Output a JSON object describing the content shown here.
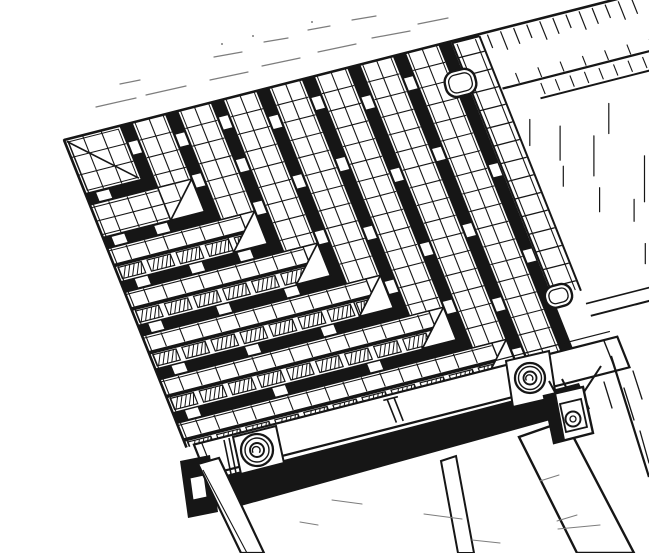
{
  "figure": {
    "title": "Isometric technical line drawing - corner detail of a slatted panel assembly with frame rail, bolts and support beams",
    "type": "monochrome engineering illustration",
    "background": "#ffffff",
    "ink": "#161616",
    "faint_ink": "#7d7d7d"
  },
  "parts": {
    "assembly": "slat-corner-assembly",
    "gusset": "corner-gusset-panel",
    "band": "l-shaped-slat-band",
    "gap": "slat-gap-band",
    "hatch_row": "hatched-slat-face",
    "tie": "gap-tie-block",
    "triangle": "elbow-miter-plate",
    "edges": "panel-edge-lines",
    "ladder": "edge-link-strip",
    "panel": "side-margin-panel",
    "margin": "top-margin-hatching",
    "rail": "frame-side-rail",
    "shadow": "under-rail-shadow",
    "legs": "support-legs",
    "beams": "diagonal-support-beams",
    "washer_left": "left-bolt-washer",
    "washer_right": "right-bolt-washer",
    "bracket": "clamp-bracket",
    "lug_top": "upper-pivot-lug",
    "lug_bottom": "lower-pivot-lug",
    "marks": "pencil-guide-marks"
  },
  "projection": {
    "origin": [
      64,
      140
    ],
    "axis_a": [
      0.969,
      -0.247
    ],
    "axis_b": [
      0.37,
      0.929
    ]
  },
  "geometry": {
    "canvas": [
      649,
      553
    ],
    "cell": 19,
    "band_width": 35,
    "gap_width": 12,
    "gusset": 58,
    "rings": [
      58,
      105,
      152,
      199,
      246,
      293,
      340,
      387
    ],
    "bands": [
      105,
      152,
      199,
      246,
      293,
      340,
      387
    ],
    "full_grid_bands": [
      105
    ],
    "hatch_bands": [
      152,
      199,
      246,
      293,
      340
    ],
    "clip_v": 331,
    "ladder": {
      "u0": 399,
      "u1": 428,
      "v0": 8,
      "v1": 272
    },
    "steep_ties": {
      "58": [
        18
      ],
      "105": [
        22,
        66
      ],
      "152": [
        16,
        62,
        108
      ],
      "199": [
        28,
        92,
        152
      ],
      "246": [
        20,
        86,
        160,
        218
      ],
      "293": [
        32,
        110,
        190,
        252
      ],
      "340": [
        24,
        100,
        182,
        262,
        316
      ],
      "387": [
        40,
        130,
        222
      ]
    },
    "shallow_ties": {
      "58": [
        10
      ],
      "105": [
        8,
        52
      ],
      "152": [
        14,
        70,
        120
      ],
      "199": [
        10,
        80,
        150
      ],
      "246": [
        16,
        92,
        170
      ],
      "293": [
        12,
        102,
        200
      ],
      "340": [
        20,
        110
      ]
    },
    "edge_ticks": {
      "e1_hang": {
        "u0": 436,
        "u1": 596,
        "step": 13.5,
        "v": 2.5,
        "len": [
          16,
          22,
          19
        ]
      },
      "e2_rise": {
        "u0": 448,
        "u1": 590,
        "step": 23,
        "v0": 47,
        "v1": 57.5
      },
      "e2e3": {
        "u0": 468,
        "u1": 600,
        "step": 15,
        "v0": 63,
        "v1": 75
      }
    },
    "panel": {
      "u0": 430,
      "u1": 860,
      "v0": 58,
      "v1": 290,
      "e2_v": 59,
      "e3_v": 78,
      "e3_u0": 462,
      "dashes": [
        [
          444,
          96,
          26
        ],
        [
          458,
          150,
          20
        ],
        [
          470,
          110,
          34
        ],
        [
          484,
          180,
          24
        ],
        [
          498,
          128,
          40
        ],
        [
          512,
          200,
          22
        ],
        [
          524,
          100,
          30
        ],
        [
          538,
          160,
          46
        ],
        [
          552,
          220,
          26
        ],
        [
          566,
          120,
          34
        ],
        [
          580,
          190,
          50
        ],
        [
          594,
          140,
          28
        ],
        [
          608,
          230,
          36
        ],
        [
          620,
          100,
          44
        ],
        [
          634,
          170,
          60
        ],
        [
          648,
          210,
          40
        ],
        [
          662,
          130,
          30
        ],
        [
          676,
          190,
          26
        ],
        [
          690,
          150,
          22
        ],
        [
          506,
          246,
          20
        ],
        [
          560,
          256,
          18
        ],
        [
          610,
          260,
          24
        ]
      ]
    },
    "rail": {
      "u0": 8,
      "u1": 445,
      "v0": 330,
      "v1": 363,
      "flange_v": 323,
      "t_u": 206
    },
    "shadow": [
      [
        211,
        479
      ],
      [
        579,
        383
      ],
      [
        590,
        409
      ],
      [
        230,
        509
      ]
    ],
    "legs": {
      "blob": [
        [
          180,
          461
        ],
        [
          210,
          455
        ],
        [
          218,
          512
        ],
        [
          188,
          518
        ]
      ],
      "notch": [
        [
          190,
          478
        ],
        [
          204,
          475
        ],
        [
          207,
          497
        ],
        [
          193,
          500
        ]
      ],
      "l1": [
        [
          198,
          464
        ],
        [
          219,
          458
        ],
        [
          264,
          553
        ],
        [
          241,
          553
        ]
      ],
      "l1_inner": [
        203,
        470,
        247,
        553
      ],
      "l2": [
        [
          441,
          461
        ],
        [
          456,
          456
        ],
        [
          474,
          553
        ],
        [
          458,
          553
        ]
      ]
    },
    "beams": {
      "b1": [
        [
          519,
          437
        ],
        [
          565,
          421
        ],
        [
          634,
          553
        ],
        [
          577,
          553
        ]
      ],
      "b1_link": [
        565,
        421,
        601,
        366
      ],
      "b1_inner": [
        [
          540,
          481,
          559,
          475
        ],
        [
          557,
          521,
          577,
          515
        ]
      ],
      "b2": [
        611,
        356,
        649,
        477
      ],
      "b2_dashes": [
        [
          624,
          388,
          634,
          420
        ],
        [
          633,
          371,
          642,
          399
        ],
        [
          640,
          431,
          649,
          463
        ],
        [
          604,
          382,
          612,
          408
        ]
      ]
    },
    "washer1": {
      "plate": [
        [
          233,
          437
        ],
        [
          276,
          426
        ],
        [
          284,
          463
        ],
        [
          241,
          474
        ]
      ],
      "tab": [
        [
          229,
          438,
          236,
          473
        ],
        [
          224,
          440,
          231,
          474
        ]
      ],
      "c": [
        257,
        450
      ],
      "r": [
        16,
        12,
        7
      ]
    },
    "washer2": {
      "plate": [
        [
          506,
          361
        ],
        [
          549,
          351
        ],
        [
          556,
          397
        ],
        [
          513,
          407
        ]
      ],
      "c": [
        530,
        378
      ],
      "r": [
        15,
        11.5,
        6.5
      ]
    },
    "bracket": {
      "outer": [
        [
          544,
          396
        ],
        [
          583,
          387
        ],
        [
          593,
          433
        ],
        [
          554,
          443
        ]
      ],
      "black": [
        [
          544,
          396
        ],
        [
          556,
          393
        ],
        [
          565,
          440
        ],
        [
          554,
          443
        ]
      ],
      "inner": [
        [
          560,
          404
        ],
        [
          581,
          399
        ],
        [
          587,
          427
        ],
        [
          566,
          432
        ]
      ],
      "bolt": [
        573,
        419,
        7.5
      ],
      "arm": [
        [
          556,
          394,
          549,
          381
        ],
        [
          568,
          391,
          562,
          379
        ]
      ]
    },
    "lugs": {
      "top": {
        "x": 445,
        "y": 70,
        "w": 31,
        "h": 26,
        "rx": 11,
        "rot": [
          -14,
          460,
          83
        ]
      },
      "bottom": {
        "x": 545,
        "y": 285,
        "w": 27,
        "h": 22,
        "rx": 10,
        "rot": [
          -15,
          558,
          296
        ]
      }
    },
    "margin_dashes": [
      [
        96,
        107,
        136,
        98
      ],
      [
        146,
        95,
        186,
        86
      ],
      [
        210,
        80,
        248,
        72
      ],
      [
        262,
        66,
        300,
        58
      ],
      [
        318,
        52,
        356,
        44
      ],
      [
        372,
        38,
        410,
        31
      ],
      [
        214,
        57,
        242,
        52
      ],
      [
        264,
        42,
        288,
        38
      ],
      [
        120,
        84,
        140,
        80
      ],
      [
        308,
        30,
        330,
        26
      ],
      [
        418,
        24,
        448,
        18
      ],
      [
        352,
        20,
        376,
        16
      ]
    ],
    "margin_dots": [
      [
        253,
        36
      ],
      [
        312,
        22
      ],
      [
        222,
        44
      ]
    ],
    "bottom_marks": [
      [
        332,
        500,
        362,
        504
      ],
      [
        424,
        514,
        462,
        519
      ],
      [
        558,
        529,
        600,
        525
      ],
      [
        472,
        540,
        500,
        543
      ],
      [
        300,
        522,
        318,
        525
      ]
    ]
  }
}
